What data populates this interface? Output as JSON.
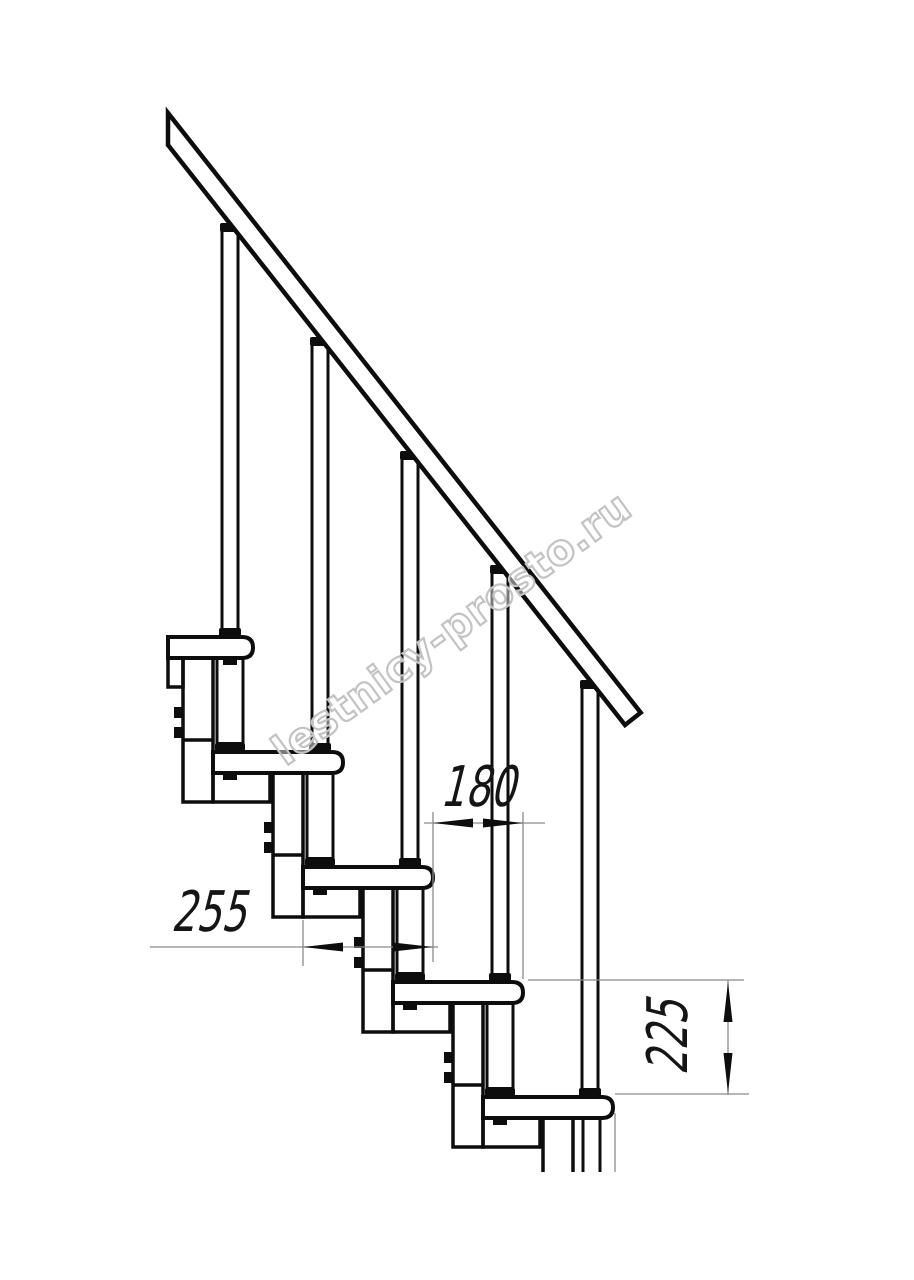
{
  "drawing": {
    "title": "modular-staircase-side-view",
    "watermark": "lestnicy-prosto.ru",
    "dimensions": {
      "step_run": "180",
      "tread_depth": "255",
      "riser_height": "225"
    },
    "line_color": "#0d0d0d",
    "dim_color": "#8a8a8a",
    "watermark_color": "#c3c3c3"
  }
}
